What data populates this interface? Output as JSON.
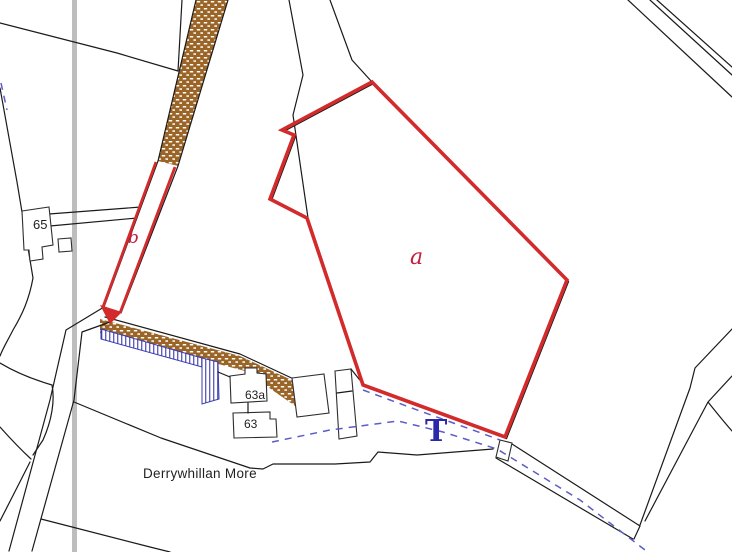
{
  "map": {
    "place_name": "Derrywhillan More",
    "parcel_a_label": "a",
    "parcel_b_label": "b",
    "building_65": "65",
    "building_63a": "63a",
    "building_63": "63",
    "t_marker": "T"
  },
  "colors": {
    "application_boundary_red": "#d32b2b",
    "parcel_letter_red": "#c2203e",
    "road_hatch_brown": "#9a6526",
    "footway_hatch_blue": "#3a3aad",
    "drain_dash_blue": "#5c5cc8",
    "t_marker_blue": "#2a2aa8",
    "grid_line_grey": "#bdbdbd",
    "boundary_line_black": "#1a1a1a",
    "text_black": "#1f1f1f"
  }
}
